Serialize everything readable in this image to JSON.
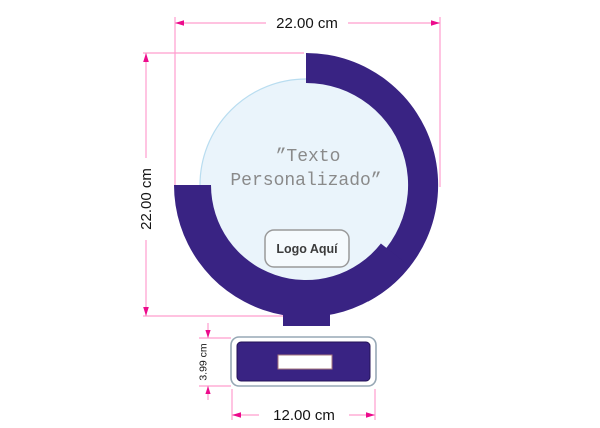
{
  "drawing": {
    "type": "trophy-spec-diagram",
    "dimensions": {
      "overall_width": "22.00 cm",
      "overall_height": "22.00 cm",
      "base_height": "3.99 cm",
      "base_width": "12.00 cm"
    },
    "plaque": {
      "custom_text_line1": "”Texto",
      "custom_text_line2": "Personalizado”",
      "logo_placeholder": "Logo Aquí"
    },
    "colors": {
      "trophy_purple": "#392383",
      "disc_fill": "#EAF4FB",
      "disc_stroke": "#B9DDF0",
      "dimension_line_pink": "#FF9DCE",
      "dimension_arrow_magenta": "#EC0B8C",
      "dimension_text": "#141414",
      "custom_text_gray": "#8A8A8A",
      "logo_text": "#3C3C3C"
    }
  }
}
